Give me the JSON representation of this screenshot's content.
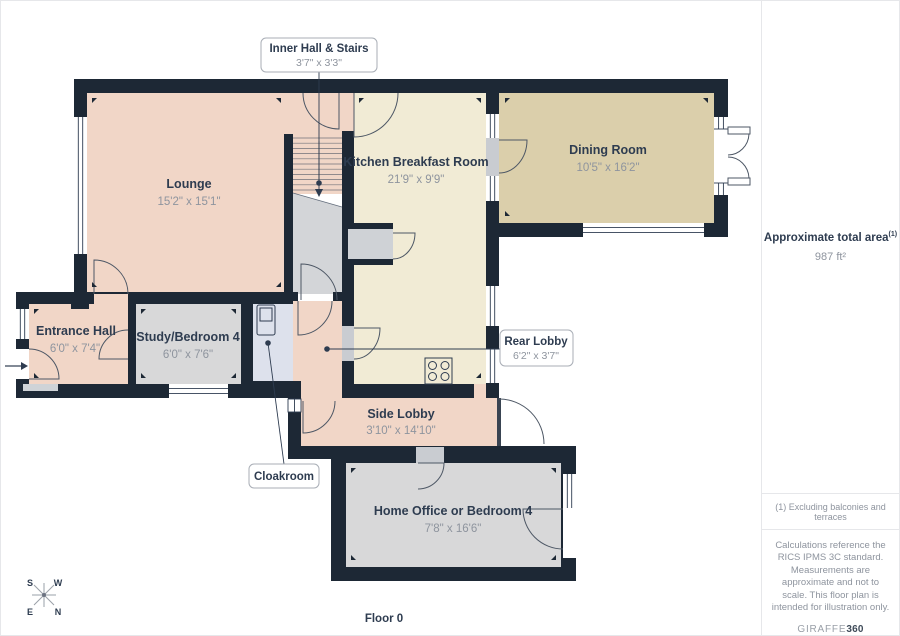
{
  "floor_label": "Floor 0",
  "rooms": [
    {
      "name": "Lounge",
      "dims": "15'2\" x 15'1\""
    },
    {
      "name": "Kitchen Breakfast Room",
      "dims": "21'9\" x 9'9\""
    },
    {
      "name": "Dining Room",
      "dims": "10'5\" x 16'2\""
    },
    {
      "name": "Entrance Hall",
      "dims": "6'0\" x 7'4\""
    },
    {
      "name": "Study/Bedroom 4",
      "dims": "6'0\" x 7'6\""
    },
    {
      "name": "Side Lobby",
      "dims": "3'10\" x 14'10\""
    },
    {
      "name": "Home Office or Bedroom 4",
      "dims": "7'8\" x 16'6\""
    }
  ],
  "callouts": [
    {
      "name": "Inner Hall & Stairs",
      "dims": "3'7\" x 3'3\""
    },
    {
      "name": "Rear Lobby",
      "dims": "6'2\" x 3'7\""
    },
    {
      "name": "Cloakroom"
    }
  ],
  "compass": {
    "top_left": "S",
    "top_right": "W",
    "bottom_left": "E",
    "bottom_right": "N"
  },
  "sidebar": {
    "total_area_label": "Approximate total area",
    "total_area_sup": "(1)",
    "total_area_value": "987 ft²",
    "footnote": "(1) Excluding balconies and terraces",
    "disclaimer": "Calculations reference the RICS IPMS 3C standard. Measurements are approximate and not to scale. This floor plan is intended for illustration only.",
    "brand_name": "GIRAFFE",
    "brand_bold": "360"
  },
  "colors": {
    "wall": "#1d2835",
    "room_pink": "#f1d6c7",
    "room_cream": "#f1ebd5",
    "room_tan": "#dbcfab",
    "room_gray": "#d8d8d9",
    "room_cloak": "#dde1ec",
    "label_dark": "#2e3c50",
    "label_gray": "#8e949e"
  }
}
